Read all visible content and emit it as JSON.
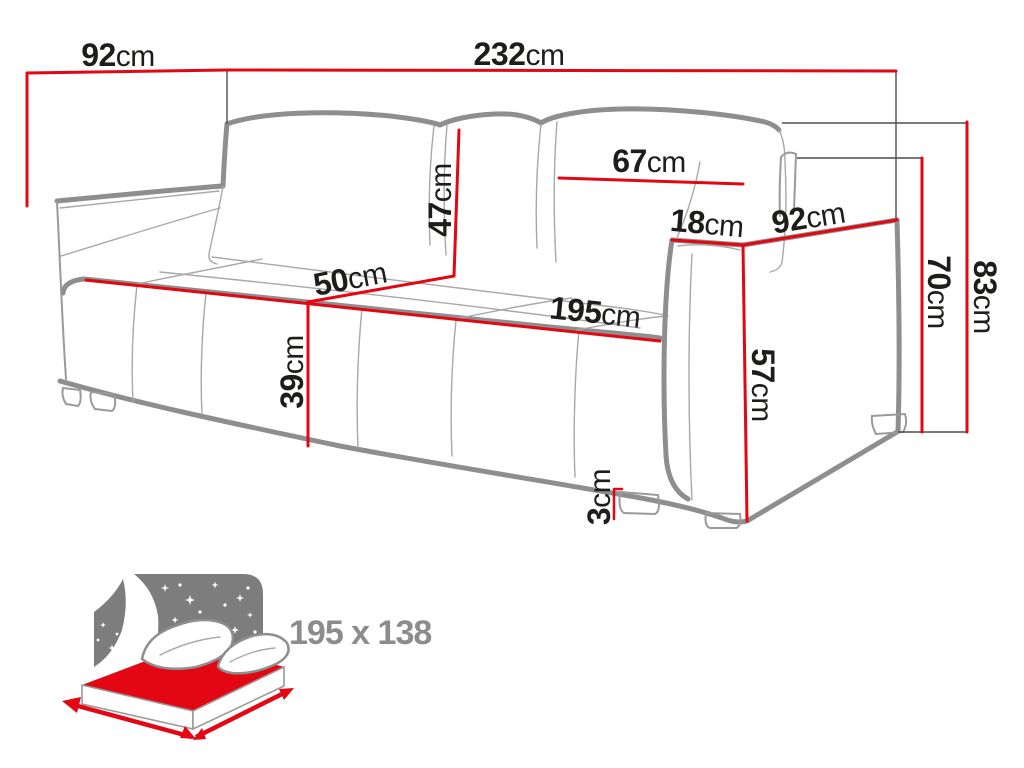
{
  "diagram_type": "sofa-dimension-drawing",
  "colors": {
    "dimension_red": "#e30613",
    "label_black": "#1d1d1b",
    "outline_gray": "#8e8e8e",
    "icon_gray": "#7d7d7d",
    "area_text_gray": "#8c8c8c"
  },
  "dims": {
    "top_depth": {
      "value": "92",
      "unit": "cm"
    },
    "total_width": {
      "value": "232",
      "unit": "cm"
    },
    "back_cushion_width": {
      "value": "67",
      "unit": "cm"
    },
    "back_cushion_height": {
      "value": "47",
      "unit": "cm"
    },
    "seat_depth": {
      "value": "50",
      "unit": "cm"
    },
    "seat_length": {
      "value": "195",
      "unit": "cm"
    },
    "seat_height": {
      "value": "39",
      "unit": "cm"
    },
    "armrest_width": {
      "value": "18",
      "unit": "cm"
    },
    "armrest_depth": {
      "value": "92",
      "unit": "cm"
    },
    "armrest_front_height": {
      "value": "57",
      "unit": "cm"
    },
    "leg_height": {
      "value": "3",
      "unit": "cm"
    },
    "armrest_height": {
      "value": "70",
      "unit": "cm"
    },
    "total_height": {
      "value": "83",
      "unit": "cm"
    }
  },
  "sleeping_area": {
    "icon": "sleeping-function-bed-icon",
    "label": "195 x 138"
  }
}
